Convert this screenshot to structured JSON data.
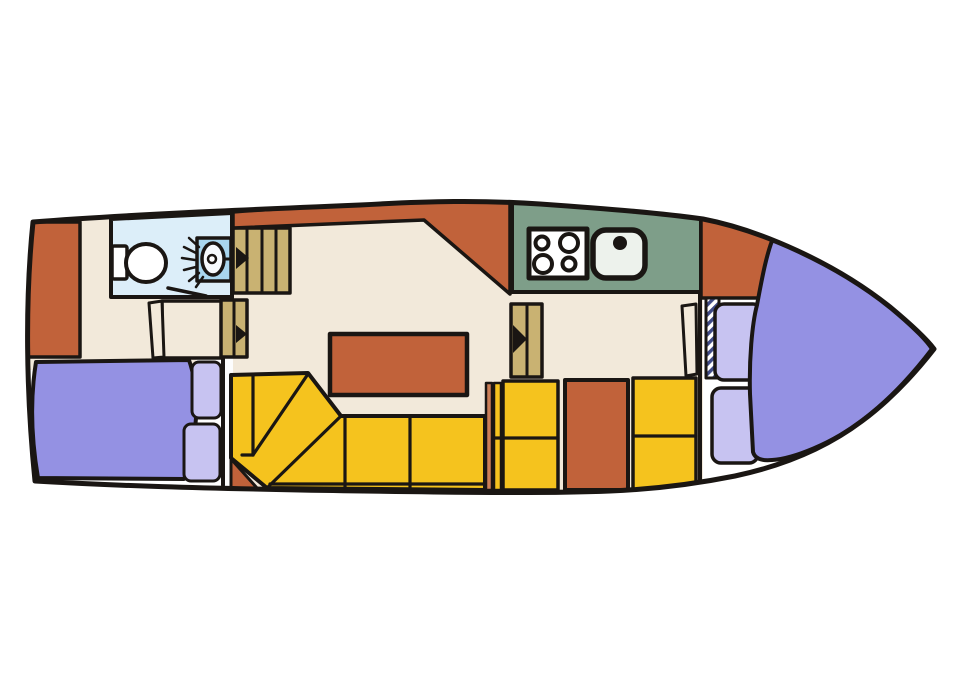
{
  "document": {
    "title": "Boat interior deck plan"
  },
  "palette": {
    "page_bg": "#ffffff",
    "outline": "#1a1613",
    "hull_fill": "#ffffff",
    "floor_cream": "#f2e9da",
    "gap_white": "#fdfdfd",
    "terracotta": "#c1623a",
    "salmon_strip": "#cc7f58",
    "sofa_yellow": "#f5c31e",
    "galley_green": "#7e9e89",
    "bed_purple": "#9491e3",
    "pillow_lavender": "#c7c3f1",
    "bath_blue": "#dceef9",
    "basin_blue": "#a9d6ee",
    "basin_white": "#f7fafd",
    "steps_tan": "#c9b272",
    "hatch_navy": "#3f4a85",
    "fixture_white": "#ffffff",
    "sink_white": "#edf2ec"
  },
  "diagram": {
    "type": "floorplan",
    "subject": "motor-yacht interior, top view, bow at right",
    "rooms": [
      {
        "id": "aft-cabin",
        "features": [
          "double berth",
          "two pillows",
          "wardrobe panel",
          "entry doors"
        ]
      },
      {
        "id": "bathroom",
        "features": [
          "toilet",
          "shower basin"
        ]
      },
      {
        "id": "salon",
        "features": [
          "L-shaped sofa",
          "table",
          "companionway steps",
          "direction arrows"
        ]
      },
      {
        "id": "galley",
        "features": [
          "four-burner stove",
          "sink"
        ]
      },
      {
        "id": "mid-berths",
        "features": [
          "two berth blocks",
          "cabinet door"
        ]
      },
      {
        "id": "bow-cabin",
        "features": [
          "V-berth",
          "two pillows",
          "hatched locker",
          "door leaf"
        ]
      }
    ]
  }
}
